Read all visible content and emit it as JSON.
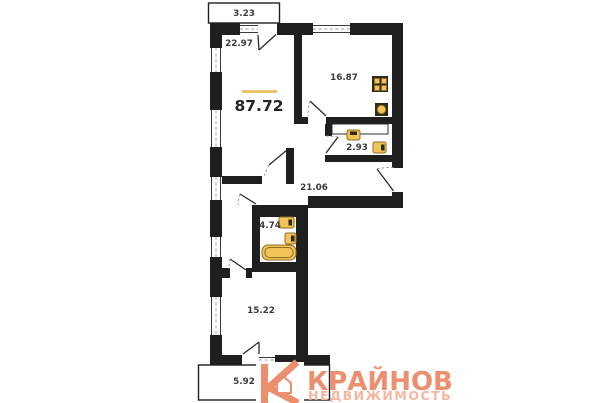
{
  "floor_plan": {
    "total_area": "87.72",
    "rooms": [
      {
        "name": "balcony-top",
        "area": "3.23"
      },
      {
        "name": "living-room",
        "area": "22.97"
      },
      {
        "name": "kitchen",
        "area": "16.87"
      },
      {
        "name": "wc",
        "area": "2.93"
      },
      {
        "name": "hallway",
        "area": "21.06"
      },
      {
        "name": "bathroom",
        "area": "4.74"
      },
      {
        "name": "bedroom",
        "area": "15.22"
      },
      {
        "name": "balcony-bottom",
        "area": "5.92"
      }
    ],
    "fixtures": [
      "stove",
      "kitchen-sink",
      "toilet",
      "wc-sink",
      "bathroom-sink",
      "bathroom-toilet",
      "bathtub"
    ]
  },
  "branding": {
    "name": "КРАЙНОВ",
    "tagline": "НЕДВИЖИМОСТЬ"
  },
  "colors": {
    "wall": "#1f1f1f",
    "background": "#ffffff",
    "fixture": "#f1c358",
    "fixture-border": "#8f6d22",
    "area-accent": "#e9b94d",
    "brand": "#ec8f6e",
    "brand-light": "#f4b79d",
    "label": "#3b3b3b"
  }
}
